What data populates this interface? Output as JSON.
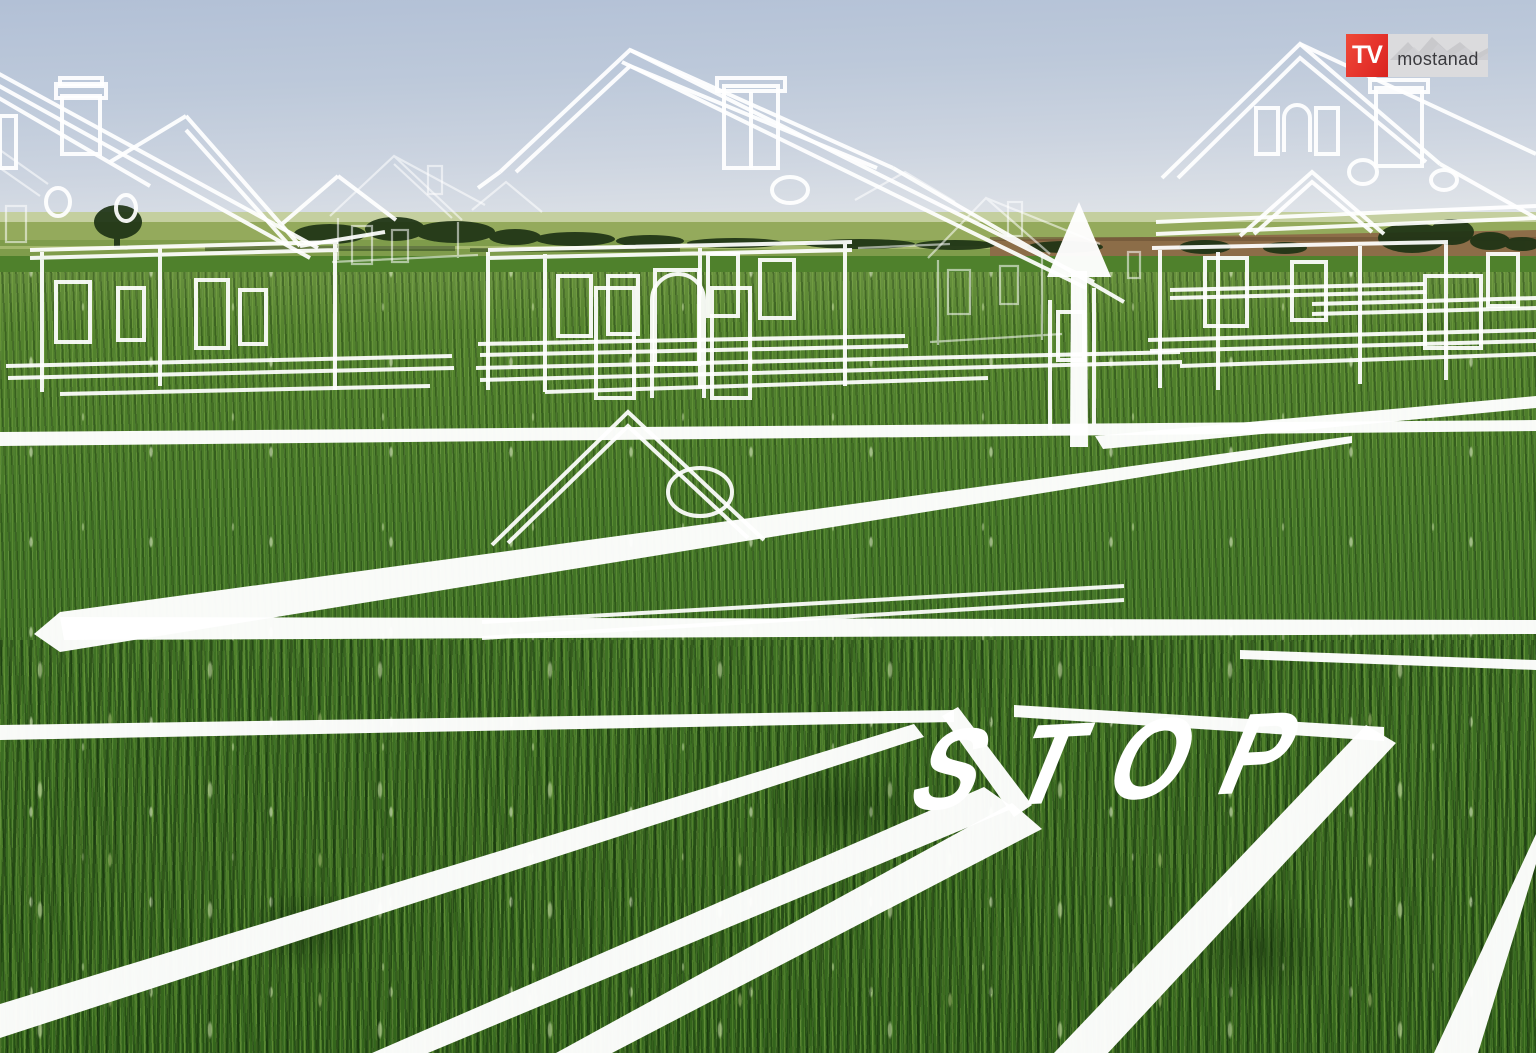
{
  "logo": {
    "tv": "TV",
    "brand": "mostanad"
  },
  "road_markings": {
    "stop": "STOP"
  },
  "icons": {
    "arrow_sign": "up-arrow-sign",
    "logo_graphic": "mountain-range"
  },
  "palette": {
    "logo_red": "#e5332c",
    "logo_gray_bg": "#dbdbdd",
    "logo_text_gray": "#3a3a3e",
    "marking_white": "#ffffff",
    "sky_top": "#b2c0d6",
    "sky_horizon": "#e9ebed",
    "grass_main": "#447627",
    "grass_dark": "#2c5419",
    "far_field_band": "#94aa5c",
    "plowed_field_brown": "#8c6d48",
    "tree_line_green": "#1e3315"
  }
}
